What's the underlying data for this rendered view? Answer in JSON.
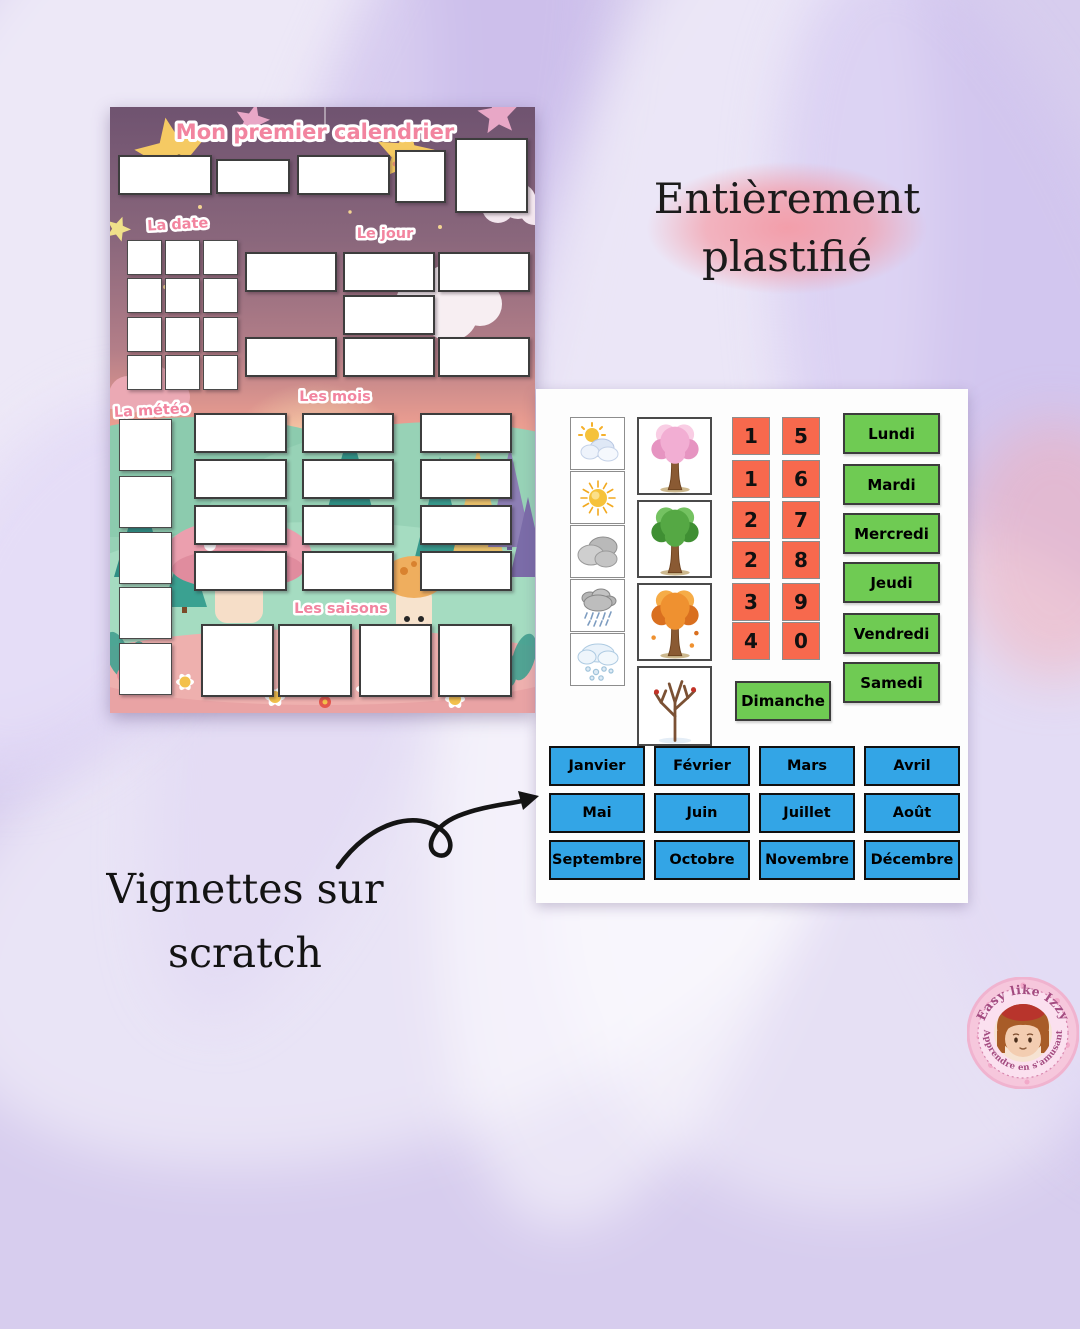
{
  "poster": {
    "title": "Mon premier calendrier",
    "labels": {
      "date": "La date",
      "day": "Le jour",
      "weather": "La météo",
      "months": "Les mois",
      "seasons": "Les saisons"
    }
  },
  "highlight": {
    "line1": "Entièrement",
    "line2": "plastifié"
  },
  "caption": {
    "line1": "Vignettes sur",
    "line2": "scratch"
  },
  "panel": {
    "weather_icons": [
      "sun-behind-cloud",
      "sun",
      "cloudy",
      "rain-cloud",
      "snow-cloud"
    ],
    "season_icons": [
      "spring-blossom-tree",
      "summer-green-tree",
      "autumn-orange-tree",
      "winter-bare-tree"
    ],
    "numbers_left": [
      "1",
      "1",
      "2",
      "2",
      "3",
      "4"
    ],
    "numbers_right": [
      "5",
      "6",
      "7",
      "8",
      "9",
      "0"
    ],
    "days": [
      "Lundi",
      "Mardi",
      "Mercredi",
      "Jeudi",
      "Vendredi",
      "Samedi"
    ],
    "sunday_label": "Dimanche",
    "months": [
      "Janvier",
      "Février",
      "Mars",
      "Avril",
      "Mai",
      "Juin",
      "Juillet",
      "Août",
      "Septembre",
      "Octobre",
      "Novembre",
      "Décembre"
    ]
  },
  "logo": {
    "arc_top": "Easy like Izzy",
    "arc_bottom": "Apprendre en s'amusant"
  },
  "colors": {
    "day_tile": "#6fcb53",
    "number_tile": "#f7694d",
    "month_tile": "#33a5e6",
    "label_pink": "#f2849f",
    "highlight_pink": "#f598a2",
    "background": "#d7cdee"
  }
}
